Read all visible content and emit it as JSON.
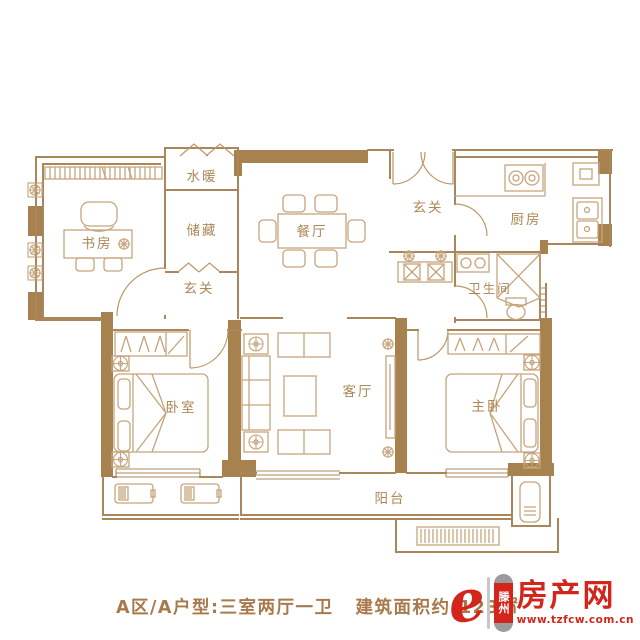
{
  "plan": {
    "rooms": [
      {
        "id": "study",
        "label": "书房"
      },
      {
        "id": "water-heating",
        "label": "水暖"
      },
      {
        "id": "storage",
        "label": "储藏"
      },
      {
        "id": "dining",
        "label": "餐厅"
      },
      {
        "id": "entry",
        "label": "玄关"
      },
      {
        "id": "kitchen",
        "label": "厨房"
      },
      {
        "id": "bathroom",
        "label": "卫生间"
      },
      {
        "id": "hallway",
        "label": "玄关"
      },
      {
        "id": "bedroom",
        "label": "卧室"
      },
      {
        "id": "living",
        "label": "客厅"
      },
      {
        "id": "master-bedroom",
        "label": "主卧"
      },
      {
        "id": "balcony",
        "label": "阳台"
      }
    ]
  },
  "caption": {
    "unit_info": "A区/A户型:三室两厅一卫",
    "area_info": "建筑面积约:123",
    "area_unit": "㎡"
  },
  "logo": {
    "mark": "e",
    "city": "滕州",
    "name": "房产网",
    "url": "www.tzfcw.com.cn"
  },
  "colors": {
    "wall": "#A8824E",
    "line": "#A9875B",
    "furniture": "#C6A47C",
    "label": "#AC8758",
    "caption_text": "#A8794B",
    "logo_red": "#D3251C"
  }
}
